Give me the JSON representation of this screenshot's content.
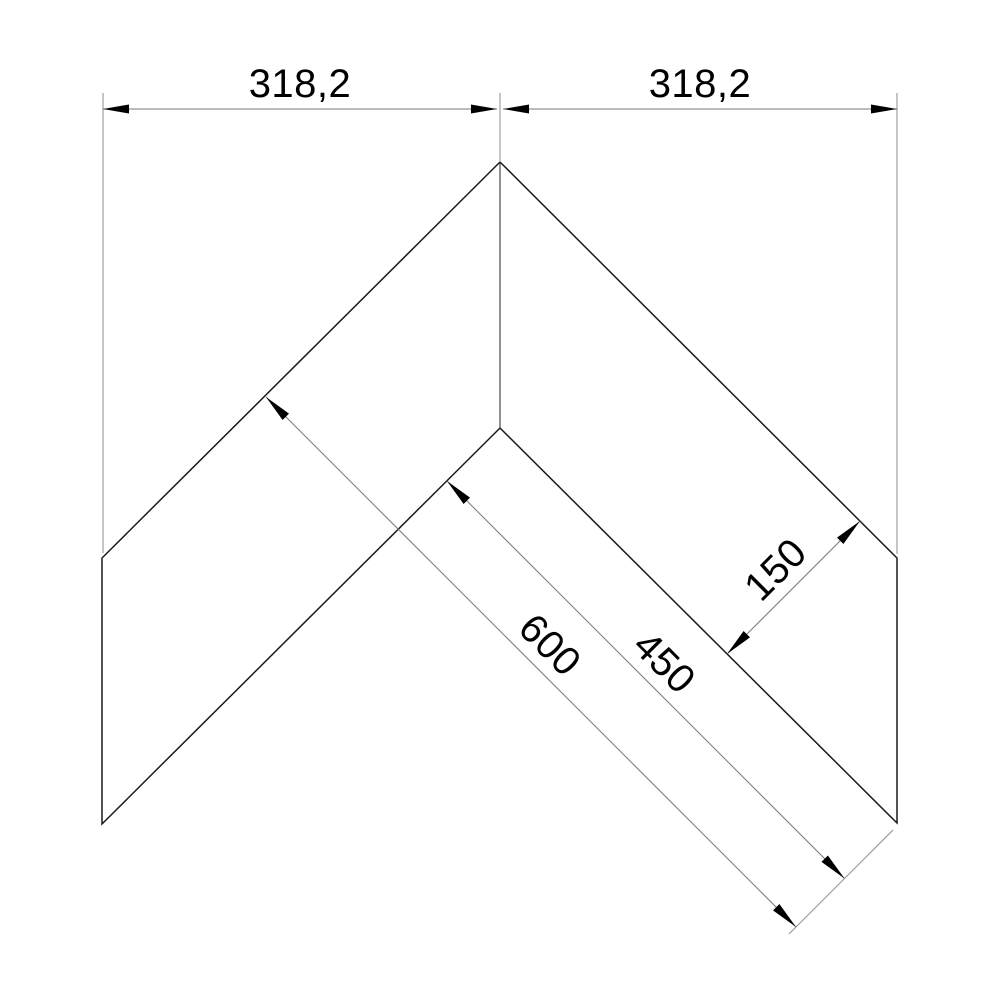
{
  "drawing": {
    "kind": "technical-dimension-drawing",
    "dimensions": {
      "top_left": "318,2",
      "top_right": "318,2",
      "strip_width": "150",
      "inner_length": "450",
      "outer_length": "600"
    },
    "colors": {
      "background": "#ffffff",
      "outline": "#1a1a1a",
      "dimension_line": "#7a7a7a",
      "text": "#000000"
    }
  }
}
